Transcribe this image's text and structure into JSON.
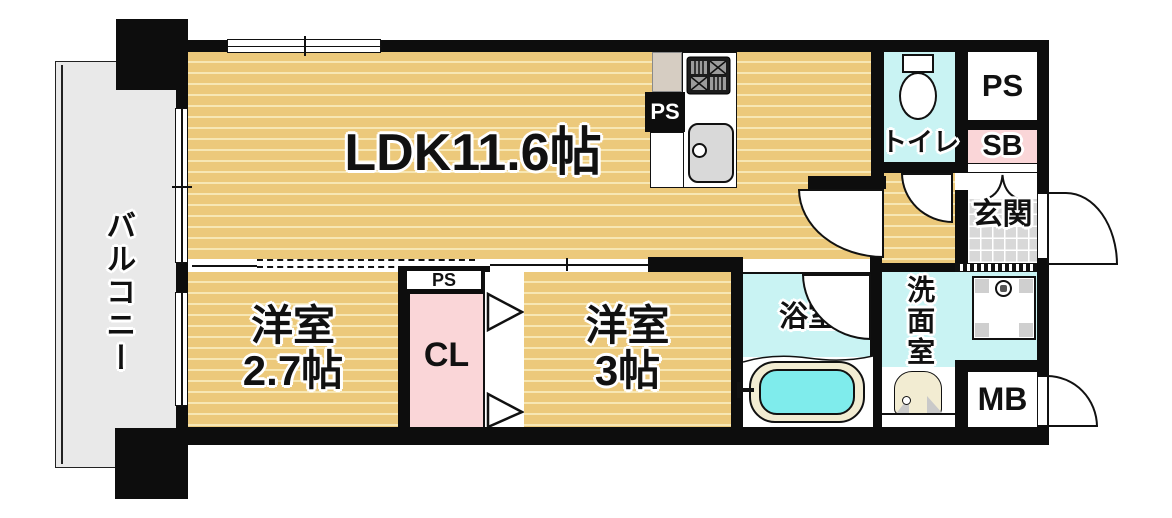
{
  "title": "1LDK apartment floor plan",
  "colors": {
    "wall": "#0d0d0d",
    "wood": "#ecc97b",
    "wood_stripe": "#f7e7b4",
    "cyan": "#c9f3f3",
    "water": "#7fecec",
    "pink": "#fad6d8",
    "balcony_gray": "#e9e9e9",
    "tile_gray": "#d8d8d8",
    "beige": "#d6cdc2",
    "sink_gray": "#d9d9d9",
    "cream": "#f2ecd2",
    "corner_gray": "#cfcfcf"
  },
  "rooms": {
    "balcony": {
      "label": "バルコニー"
    },
    "ldk": {
      "label": "LDK11.6帖"
    },
    "western_room_2_7": {
      "name": "洋室",
      "size": "2.7帖"
    },
    "western_room_3": {
      "name": "洋室",
      "size": "3帖"
    },
    "closet": {
      "label": "CL"
    },
    "closet_ps": {
      "label": "PS"
    },
    "kitchen_ps": {
      "label": "PS"
    },
    "pipe_space": {
      "label": "PS"
    },
    "shoe_box": {
      "label": "SB"
    },
    "entrance": {
      "label": "玄関"
    },
    "toilet": {
      "label": "トイレ"
    },
    "bathroom": {
      "label": "浴室"
    },
    "washroom": {
      "label": "洗面室"
    },
    "meter_box": {
      "label": "MB"
    }
  }
}
